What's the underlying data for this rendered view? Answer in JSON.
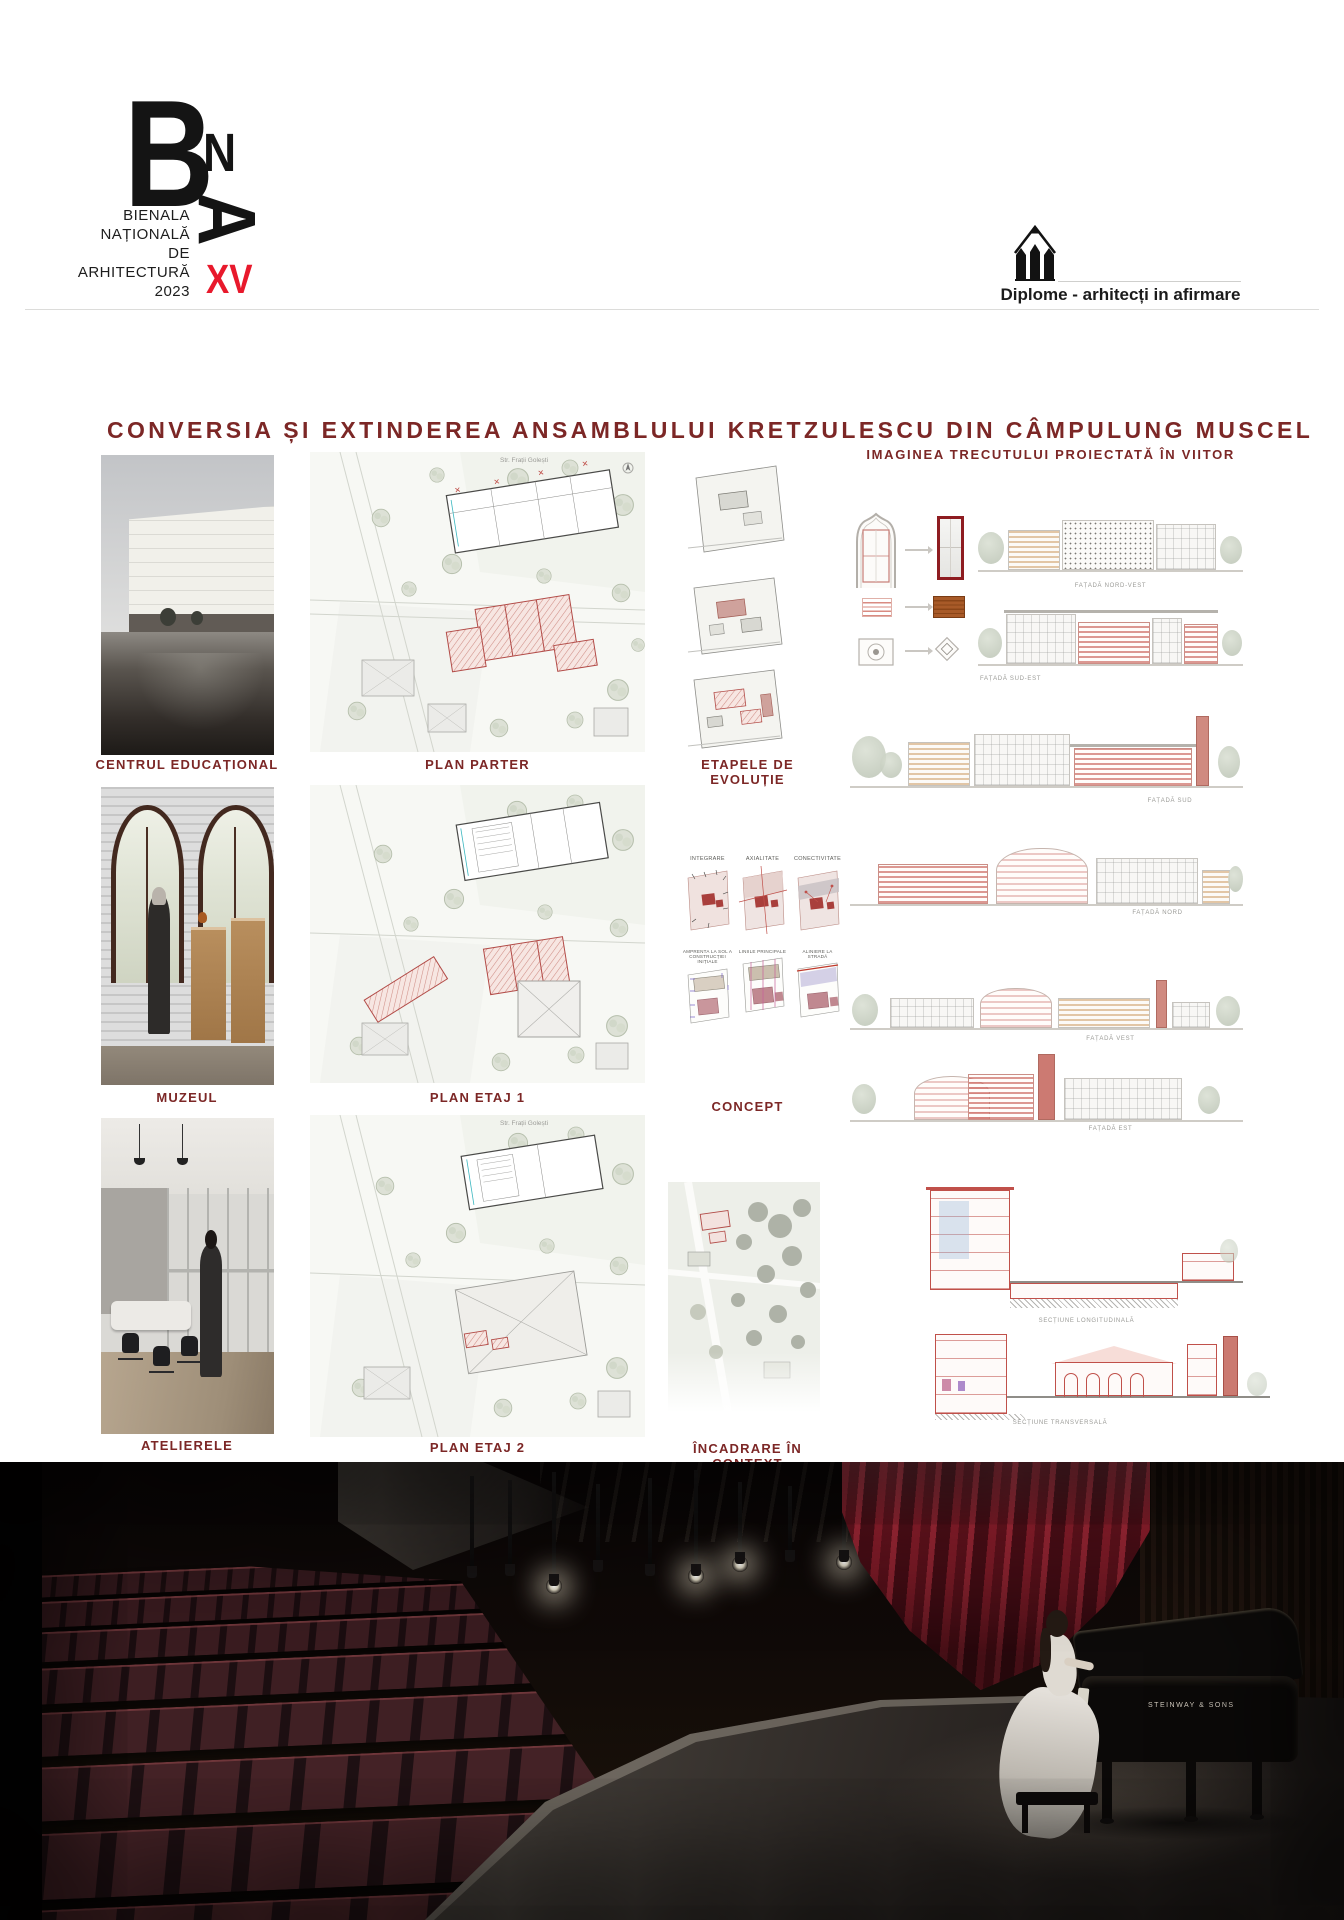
{
  "header": {
    "logo": {
      "letter_b": "B",
      "letter_n": "N",
      "letter_a": "A",
      "lines": [
        "BIENALA",
        "NAȚIONALĂ",
        "DE",
        "ARHITECTURĂ",
        "2023"
      ],
      "edition": "XV"
    },
    "program": {
      "label": "Diplome - arhitecți in afirmare"
    }
  },
  "title": "CONVERSIA ȘI EXTINDEREA ANSAMBLULUI KRETZULESCU DIN CÂMPULUNG MUSCEL",
  "right_heading": "IMAGINEA TRECUTULUI PROIECTATĂ ÎN VIITOR",
  "renders": {
    "r1": "CENTRUL EDUCAȚIONAL",
    "r2": "MUZEUL",
    "r3": "ATELIERELE"
  },
  "plans": {
    "p1": "PLAN PARTER",
    "p2": "PLAN ETAJ 1",
    "p3": "PLAN ETAJ 2",
    "street": "Str. Frații Golești"
  },
  "analysis": {
    "stages": "ETAPELE DE EVOLUȚIE",
    "concept": "CONCEPT",
    "context": "ÎNCADRARE ÎN CONTEXT",
    "concept_row1": [
      "INTEGRARE",
      "AXIALITATE",
      "CONECTIVITATE"
    ],
    "concept_row2": [
      "AMPRENTA LA SOL A CONSTRUCȚIEI INIȚIALE",
      "LINIILE PRINCIPALE",
      "ALINIERE LA STRADĂ"
    ]
  },
  "facades": {
    "f1": "FAȚADĂ NORD-VEST",
    "f2": "FAȚADĂ SUD-EST",
    "f3": "FAȚADĂ SUD",
    "f4": "FAȚADĂ NORD",
    "f5": "FAȚADĂ VEST",
    "f6": "FAȚADĂ EST",
    "s1": "SECȚIUNE LONGITUDINALĂ",
    "s2": "SECȚIUNE TRANSVERSALĂ"
  },
  "stage_photo": {
    "piano_brand": "STEINWAY & SONS"
  },
  "colors": {
    "accent": "#7c2726",
    "edition_red": "#e8192c",
    "label_gray": "#9b9b97"
  }
}
